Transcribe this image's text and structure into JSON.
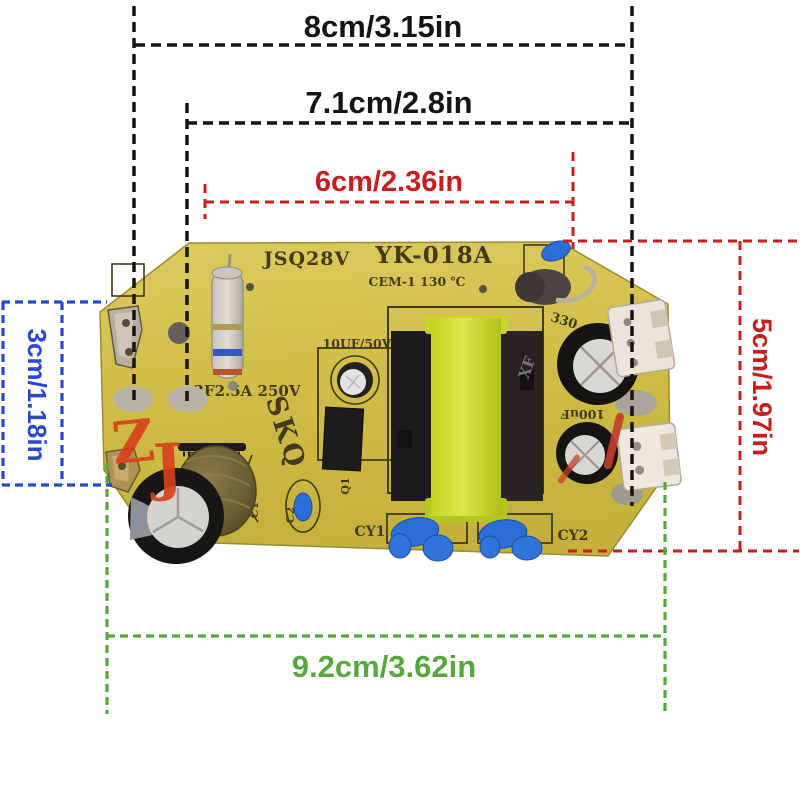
{
  "image_type": "product-photo-with-dimension-annotations",
  "subject": "humidifier power supply PCB module",
  "dimensions": {
    "width_top": "8cm/3.15in",
    "width_mid": "7.1cm/2.8in",
    "width_inner": "6cm/2.36in",
    "height_left": "3cm/1.18in",
    "height_right": "5cm/1.97in",
    "width_bottom": "9.2cm/3.62in"
  },
  "board": {
    "silkscreen": {
      "code_left": "JSQ28V",
      "model": "YK-018A",
      "material_rating": "CEM-1 130 ℃",
      "fuse_rating": "3F2.5A 250V",
      "logo": "SKQ",
      "cap_small_rating": "10UF/50V",
      "cap_330_label": "330",
      "cap_100uf_label": "100uF",
      "cy1_label": "CY1",
      "cy2_label": "CY2",
      "q1_label": "Q1",
      "c1_label": "C1",
      "c2_label": "C2",
      "diode_label": "400V22",
      "core_mark": "XF"
    },
    "watermark_z": "Z",
    "watermark_j": "J"
  },
  "colors": {
    "dim_black": "#141414",
    "dim_red": "#c5201f",
    "dim_blue": "#2847cf",
    "dim_green": "#56a83c",
    "board_yellow": "#d2bf47",
    "bobbin_yellow": "#c9dc30",
    "cap_blue": "#2b6fd6",
    "watermark_red": "#d8401c",
    "silkscreen": "#44391b"
  }
}
